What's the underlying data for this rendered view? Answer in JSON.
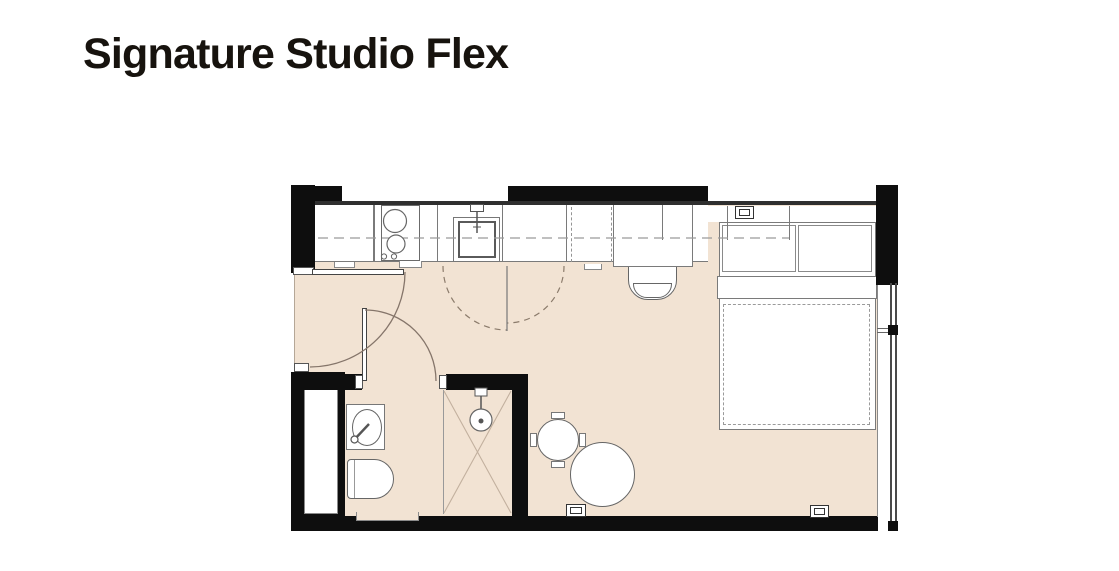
{
  "page": {
    "title": "Signature Studio Flex"
  },
  "theme": {
    "bg": "#ffffff",
    "wall_color": "#0e0e0e",
    "floor_color": "#f2e3d3",
    "line_color": "#7a7a7a",
    "text_color": "#17130e"
  },
  "floorplan": {
    "unit_name": "Signature Studio Flex",
    "rooms": [
      "entry",
      "kitchen",
      "living-sleeping-area",
      "bathroom"
    ],
    "fixtures": [
      "kitchen-counter",
      "cooktop-two-burners",
      "kitchen-sink",
      "upper-cabinets-dashed",
      "tall-cabinet",
      "desk",
      "desk-chair",
      "folding-doors",
      "entry-door",
      "bathroom-door",
      "double-bed",
      "pillows",
      "duvet",
      "overhead-shelf",
      "dining-table",
      "pouf",
      "washbasin",
      "toilet",
      "shower",
      "service-shaft",
      "window-wall",
      "power-outlets"
    ]
  }
}
